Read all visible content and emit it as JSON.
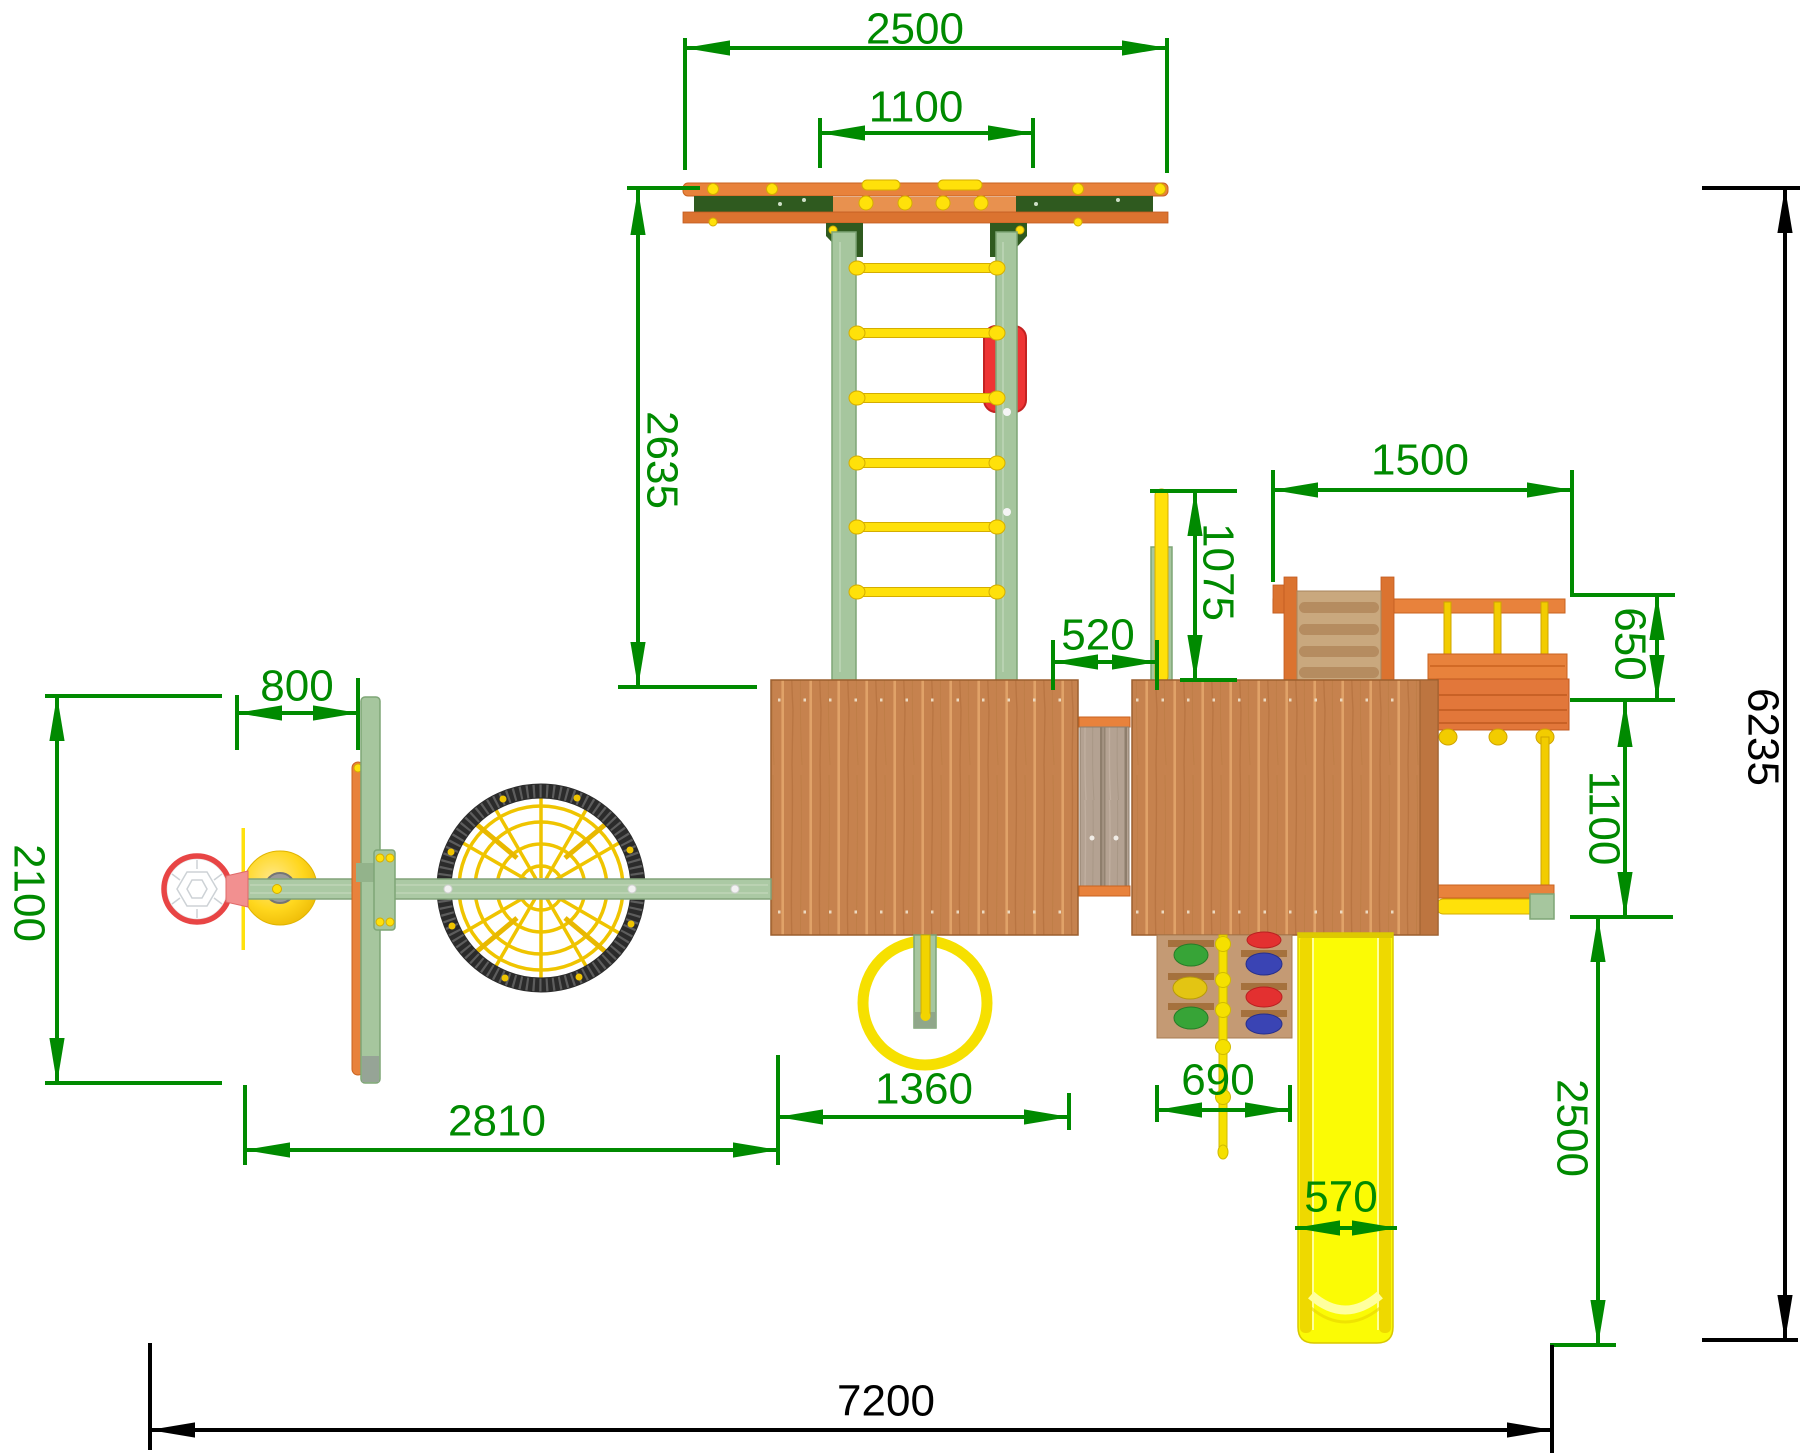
{
  "drawing": {
    "type": "playground-equipment-top-view",
    "units": "mm"
  },
  "dims": {
    "frame_width": "2500",
    "ladder_width": "1100",
    "ladder_length": "2635",
    "pole_height": "1075",
    "bridge_length": "520",
    "side_module_width": "1500",
    "rope_ladder_depth": "650",
    "hoop_offset": "800",
    "swing_depth": "2100",
    "monkey_rung_span": "1100",
    "slide_run": "2500",
    "ring_bay": "1360",
    "swing_bay": "2810",
    "climb_wall_width": "690",
    "slide_width": "570",
    "overall_depth": "6235",
    "overall_width": "7200"
  },
  "colors": {
    "dim_green": "#008a00",
    "dim_black": "#000000",
    "orange": "#e8823c",
    "dark_green": "#2f5a1f",
    "frame_green": "#a6c69e",
    "yellow": "#ffe10a",
    "slide_yellow": "#fbfb05",
    "wood": "#c6824e",
    "red": "#ee3434"
  }
}
